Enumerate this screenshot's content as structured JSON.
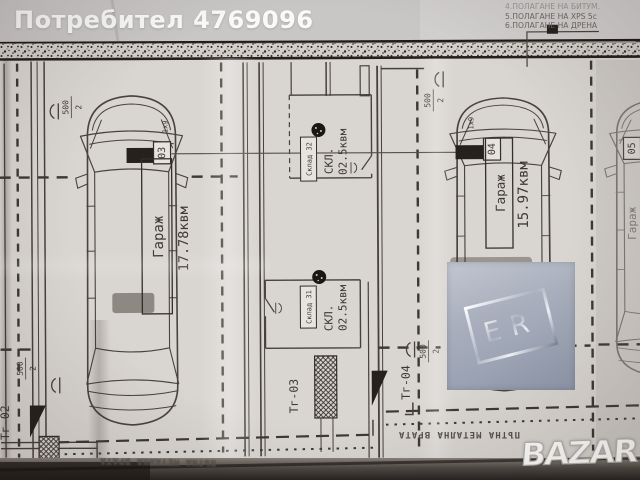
{
  "photo": {
    "user_watermark": "Потребител 4769096",
    "bazar_watermark": "BAZAR",
    "er_badge": "ER"
  },
  "notes": {
    "line_4": "4.ПОЛАГАНЕ НА БИТУМ.",
    "line_5": "5.ПОЛАГАНЕ НА XPS 5с",
    "line_6": "6.ПОЛАГАНЕ НА ДРЕНА"
  },
  "garages": {
    "g03": {
      "tag": "03",
      "label": "Гараж",
      "area": "17.78квм",
      "size_note": "1х9"
    },
    "g04": {
      "tag": "04",
      "label": "Гараж",
      "area": "15.97квм",
      "size_note": "1х9"
    },
    "g05": {
      "tag": "05",
      "label": "Гараж"
    }
  },
  "storages": {
    "s32": {
      "tag": "Склад 32",
      "label": "СКЛ.",
      "area": "02.5квм"
    },
    "s31": {
      "tag": "Склад 31",
      "label": "СКЛ.",
      "area": "02.5квм"
    }
  },
  "gates": {
    "tg02": "Тг-02",
    "tg03": "Тг-03",
    "tg04": "Тг-04"
  },
  "dims": {
    "w500": "500",
    "axis2": "2"
  },
  "gate_caption": "ПЪТНА МЕТАЛНА ВРАТА",
  "colors": {
    "paper": "#d9d5d1",
    "ink": "#47413b",
    "dark_fill": "#26211c",
    "er_panel": "#9aa2b3"
  }
}
